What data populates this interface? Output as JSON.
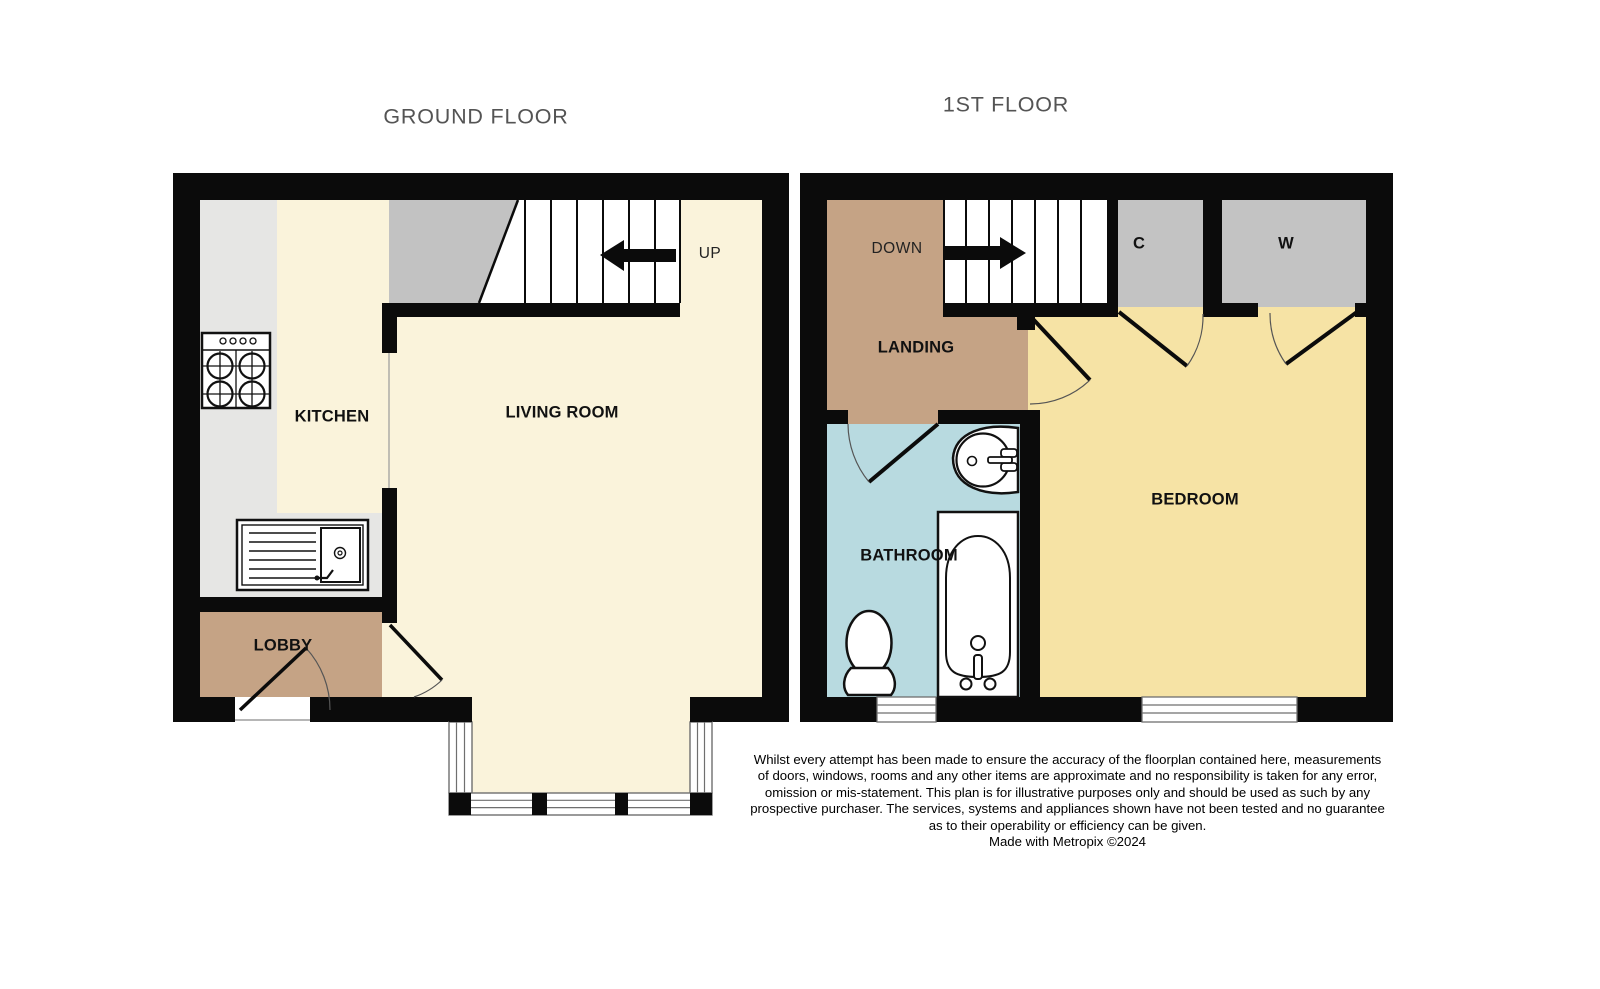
{
  "ground_floor": {
    "title": "GROUND FLOOR",
    "labels": {
      "kitchen": "KITCHEN",
      "living_room": "LIVING ROOM",
      "lobby": "LOBBY",
      "stairs_direction": "UP"
    }
  },
  "first_floor": {
    "title": "1ST FLOOR",
    "labels": {
      "landing": "LANDING",
      "bathroom": "BATHROOM",
      "bedroom": "BEDROOM",
      "cupboard": "C",
      "wardrobe": "W",
      "stairs_direction": "DOWN"
    }
  },
  "footer": {
    "disclaimer": "Whilst every attempt has been made to ensure the accuracy of the floorplan contained here, measurements\nof doors, windows, rooms and any other items are approximate and no responsibility is taken for any error,\nomission or mis-statement. This plan is for illustrative purposes only and should be used as such by any\nprospective purchaser. The services, systems and appliances shown have not been tested and no guarantee\nas to their operability or efficiency can be given.",
    "credit": "Made with Metropix ©2024"
  },
  "colors": {
    "wall": "#0b0b0b",
    "floor_cream": "#faf3db",
    "floor_yellow": "#f6e3a5",
    "floor_brown": "#c5a385",
    "floor_blue": "#b8dae0",
    "closet_gray": "#c3c3c3",
    "counter_gray": "#e6e6e4",
    "understair_gray": "#c2c2c2",
    "title_gray": "#545454"
  }
}
